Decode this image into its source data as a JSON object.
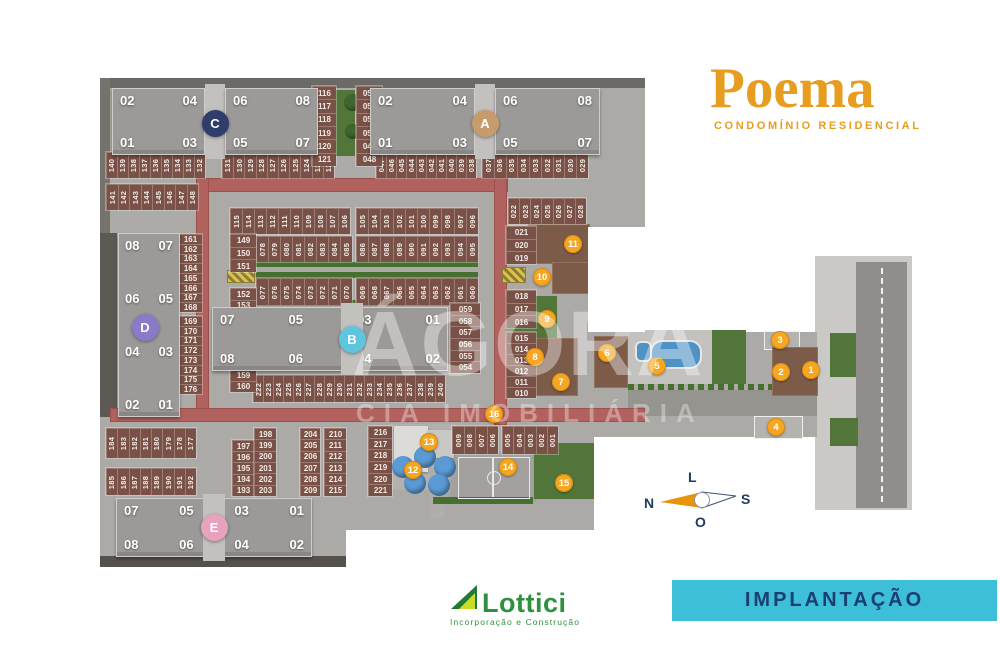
{
  "header": {
    "project_title": "Poema",
    "project_subtitle": "CONDOMÍNIO RESIDENCIAL"
  },
  "banner": {
    "label": "IMPLANTAÇÃO"
  },
  "developer": {
    "name": "Lottici",
    "tagline": "Incorporação e Construção"
  },
  "watermark": {
    "line1": "ÁGORA",
    "line2": "CIA IMOBILIÁRIA"
  },
  "compass": {
    "north": "N",
    "south": "S",
    "east": "L",
    "west": "O"
  },
  "colors": {
    "brand_orange": "#e79d1f",
    "marker_orange": "#f5a623",
    "banner_bg": "#3ebfd9",
    "banner_text": "#1c3e70",
    "lottici_green": "#2d9141",
    "internal_road_red": "#b2625e",
    "parking_brown": "#7a5146",
    "building_gray": "#9c9a98",
    "ground_gray": "#acaaa7",
    "green": "#527539",
    "pool_blue": "#4e92c6",
    "tower_a": "#c69c6d",
    "tower_b": "#5fc4de",
    "tower_c": "#2e3d69",
    "tower_d": "#8a7bc8",
    "tower_e": "#e8a2be"
  },
  "site": {
    "buildings": [
      {
        "id": "C",
        "type": "double",
        "x": 112,
        "y": 88,
        "w": 206,
        "h": 67,
        "slab1_units": [
          "02",
          "04",
          "01",
          "03"
        ],
        "slab2_units": [
          "06",
          "08",
          "05",
          "07"
        ],
        "circle_color": "#2e3d69"
      },
      {
        "id": "A",
        "type": "double",
        "x": 370,
        "y": 88,
        "w": 230,
        "h": 67,
        "slab1_units": [
          "02",
          "04",
          "01",
          "03"
        ],
        "slab2_units": [
          "06",
          "08",
          "05",
          "07"
        ],
        "circle_color": "#c69c6d"
      },
      {
        "id": "B",
        "type": "single",
        "x": 212,
        "y": 307,
        "w": 236,
        "h": 64,
        "circle_dx": 22,
        "top": [
          "07",
          "05",
          "03",
          "01"
        ],
        "bottom": [
          "08",
          "06",
          "04",
          "02"
        ],
        "circle_color": "#5fc4de"
      },
      {
        "id": "E",
        "type": "single",
        "x": 116,
        "y": 498,
        "w": 196,
        "h": 59,
        "circle_dx": 0,
        "top": [
          "07",
          "05",
          "03",
          "01"
        ],
        "bottom": [
          "08",
          "06",
          "04",
          "02"
        ],
        "circle_color": "#e8a2be"
      },
      {
        "id": "D",
        "type": "vertical",
        "x": 118,
        "y": 233,
        "w": 62,
        "h": 184,
        "rows": [
          [
            "08",
            "07"
          ],
          [
            "06",
            "05"
          ],
          [
            "04",
            "03"
          ],
          [
            "02",
            "01"
          ]
        ],
        "circle_color": "#8a7bc8"
      }
    ],
    "parking_groups": [
      {
        "id": "140-132",
        "dir": "row",
        "x": 106,
        "y": 152,
        "w": 99,
        "h": 26,
        "values": [
          "140",
          "139",
          "138",
          "137",
          "136",
          "135",
          "134",
          "133",
          "132"
        ]
      },
      {
        "id": "131-122",
        "dir": "row",
        "x": 222,
        "y": 152,
        "w": 112,
        "h": 26,
        "values": [
          "131",
          "130",
          "129",
          "128",
          "127",
          "126",
          "125",
          "124",
          "123",
          "122"
        ]
      },
      {
        "id": "047-038",
        "dir": "row",
        "x": 376,
        "y": 152,
        "w": 100,
        "h": 26,
        "values": [
          "047",
          "046",
          "045",
          "044",
          "043",
          "042",
          "041",
          "040",
          "039",
          "038"
        ]
      },
      {
        "id": "037-029",
        "dir": "row",
        "x": 482,
        "y": 152,
        "w": 106,
        "h": 26,
        "values": [
          "037",
          "036",
          "035",
          "034",
          "033",
          "032",
          "031",
          "030",
          "029"
        ]
      },
      {
        "id": "141-148",
        "dir": "row",
        "x": 106,
        "y": 184,
        "w": 92,
        "h": 26,
        "values": [
          "141",
          "142",
          "143",
          "144",
          "145",
          "146",
          "147",
          "148"
        ]
      },
      {
        "id": "022-028",
        "dir": "row",
        "x": 508,
        "y": 198,
        "w": 78,
        "h": 26,
        "values": [
          "022",
          "023",
          "024",
          "025",
          "026",
          "027",
          "028"
        ]
      },
      {
        "id": "115-106",
        "dir": "row",
        "x": 230,
        "y": 208,
        "w": 120,
        "h": 26,
        "values": [
          "115",
          "114",
          "113",
          "112",
          "111",
          "110",
          "109",
          "108",
          "107",
          "106"
        ]
      },
      {
        "id": "105-096",
        "dir": "row",
        "x": 356,
        "y": 208,
        "w": 122,
        "h": 26,
        "values": [
          "105",
          "104",
          "103",
          "102",
          "101",
          "100",
          "099",
          "098",
          "097",
          "096"
        ]
      },
      {
        "id": "078-085",
        "dir": "row",
        "x": 256,
        "y": 236,
        "w": 96,
        "h": 26,
        "values": [
          "078",
          "079",
          "080",
          "081",
          "082",
          "083",
          "084",
          "085"
        ]
      },
      {
        "id": "086-095",
        "dir": "row",
        "x": 356,
        "y": 236,
        "w": 122,
        "h": 26,
        "values": [
          "086",
          "087",
          "088",
          "089",
          "090",
          "091",
          "092",
          "093",
          "094",
          "095"
        ]
      },
      {
        "id": "077-070",
        "dir": "row",
        "x": 256,
        "y": 278,
        "w": 96,
        "h": 27,
        "values": [
          "077",
          "076",
          "075",
          "074",
          "073",
          "072",
          "071",
          "070"
        ]
      },
      {
        "id": "069-060",
        "dir": "row",
        "x": 356,
        "y": 278,
        "w": 122,
        "h": 27,
        "values": [
          "069",
          "068",
          "067",
          "066",
          "065",
          "064",
          "063",
          "062",
          "061",
          "060"
        ]
      },
      {
        "id": "222-240",
        "dir": "row",
        "x": 253,
        "y": 375,
        "w": 192,
        "h": 27,
        "values": [
          "222",
          "223",
          "224",
          "225",
          "226",
          "227",
          "228",
          "229",
          "230",
          "231",
          "232",
          "233",
          "234",
          "235",
          "236",
          "237",
          "238",
          "239",
          "240"
        ]
      },
      {
        "id": "184-177",
        "dir": "row",
        "x": 106,
        "y": 428,
        "w": 90,
        "h": 30,
        "values": [
          "184",
          "183",
          "182",
          "181",
          "180",
          "179",
          "178",
          "177"
        ]
      },
      {
        "id": "185-192",
        "dir": "row",
        "x": 106,
        "y": 468,
        "w": 90,
        "h": 27,
        "values": [
          "185",
          "186",
          "187",
          "188",
          "189",
          "190",
          "191",
          "192"
        ]
      },
      {
        "id": "009-006",
        "dir": "row",
        "x": 452,
        "y": 426,
        "w": 46,
        "h": 28,
        "values": [
          "009",
          "008",
          "007",
          "006"
        ]
      },
      {
        "id": "005-001",
        "dir": "row",
        "x": 502,
        "y": 426,
        "w": 56,
        "h": 28,
        "values": [
          "005",
          "004",
          "003",
          "002",
          "001"
        ]
      },
      {
        "id": "116-121",
        "dir": "col",
        "x": 312,
        "y": 86,
        "w": 24,
        "h": 80,
        "values": [
          "116",
          "117",
          "118",
          "119",
          "120",
          "121"
        ]
      },
      {
        "id": "053-048",
        "dir": "col",
        "x": 356,
        "y": 86,
        "w": 26,
        "h": 80,
        "values": [
          "053",
          "052",
          "051",
          "050",
          "049",
          "048"
        ]
      },
      {
        "id": "149-151",
        "dir": "col",
        "x": 230,
        "y": 234,
        "w": 26,
        "h": 38,
        "values": [
          "149",
          "150",
          "151"
        ]
      },
      {
        "id": "161-168",
        "dir": "col",
        "x": 178,
        "y": 234,
        "w": 24,
        "h": 78,
        "values": [
          "161",
          "162",
          "163",
          "164",
          "165",
          "166",
          "167",
          "168"
        ]
      },
      {
        "id": "152-160",
        "dir": "col",
        "x": 230,
        "y": 288,
        "w": 26,
        "h": 104,
        "values": [
          "152",
          "153",
          "154",
          "155",
          "156",
          "157",
          "158",
          "159",
          "160"
        ]
      },
      {
        "id": "169-176",
        "dir": "col",
        "x": 178,
        "y": 316,
        "w": 24,
        "h": 78,
        "values": [
          "169",
          "170",
          "171",
          "172",
          "173",
          "174",
          "175",
          "176"
        ]
      },
      {
        "id": "059-054",
        "dir": "col",
        "x": 450,
        "y": 303,
        "w": 30,
        "h": 70,
        "values": [
          "059",
          "058",
          "057",
          "056",
          "055",
          "054"
        ]
      },
      {
        "id": "021-019",
        "dir": "col",
        "x": 506,
        "y": 226,
        "w": 30,
        "h": 38,
        "values": [
          "021",
          "020",
          "019"
        ]
      },
      {
        "id": "018-016",
        "dir": "col",
        "x": 506,
        "y": 290,
        "w": 30,
        "h": 38,
        "values": [
          "018",
          "017",
          "016"
        ]
      },
      {
        "id": "015-010",
        "dir": "col",
        "x": 506,
        "y": 332,
        "w": 30,
        "h": 66,
        "values": [
          "015",
          "014",
          "013",
          "012",
          "011",
          "010"
        ]
      },
      {
        "id": "197-193",
        "dir": "col",
        "x": 232,
        "y": 440,
        "w": 22,
        "h": 56,
        "values": [
          "197",
          "196",
          "195",
          "194",
          "193"
        ]
      },
      {
        "id": "198-203",
        "dir": "col",
        "x": 254,
        "y": 428,
        "w": 22,
        "h": 68,
        "values": [
          "198",
          "199",
          "200",
          "201",
          "202",
          "203"
        ]
      },
      {
        "id": "204-209",
        "dir": "col",
        "x": 300,
        "y": 428,
        "w": 20,
        "h": 68,
        "values": [
          "204",
          "205",
          "206",
          "207",
          "208",
          "209"
        ]
      },
      {
        "id": "210-215",
        "dir": "col",
        "x": 324,
        "y": 428,
        "w": 22,
        "h": 68,
        "values": [
          "210",
          "211",
          "212",
          "213",
          "214",
          "215"
        ]
      },
      {
        "id": "216-221",
        "dir": "col",
        "x": 368,
        "y": 426,
        "w": 24,
        "h": 70,
        "values": [
          "216",
          "217",
          "218",
          "219",
          "220",
          "221"
        ]
      }
    ],
    "amenity_markers": [
      {
        "n": "1",
        "x": 811,
        "y": 370
      },
      {
        "n": "2",
        "x": 781,
        "y": 372
      },
      {
        "n": "3",
        "x": 780,
        "y": 340
      },
      {
        "n": "4",
        "x": 776,
        "y": 427
      },
      {
        "n": "5",
        "x": 657,
        "y": 366
      },
      {
        "n": "6",
        "x": 607,
        "y": 353
      },
      {
        "n": "7",
        "x": 561,
        "y": 382
      },
      {
        "n": "8",
        "x": 535,
        "y": 357
      },
      {
        "n": "9",
        "x": 547,
        "y": 319
      },
      {
        "n": "10",
        "x": 542,
        "y": 277
      },
      {
        "n": "11",
        "x": 573,
        "y": 244
      },
      {
        "n": "12",
        "x": 413,
        "y": 470
      },
      {
        "n": "13",
        "x": 429,
        "y": 442
      },
      {
        "n": "14",
        "x": 508,
        "y": 467
      },
      {
        "n": "15",
        "x": 564,
        "y": 483
      },
      {
        "n": "16",
        "x": 494,
        "y": 414
      }
    ]
  }
}
